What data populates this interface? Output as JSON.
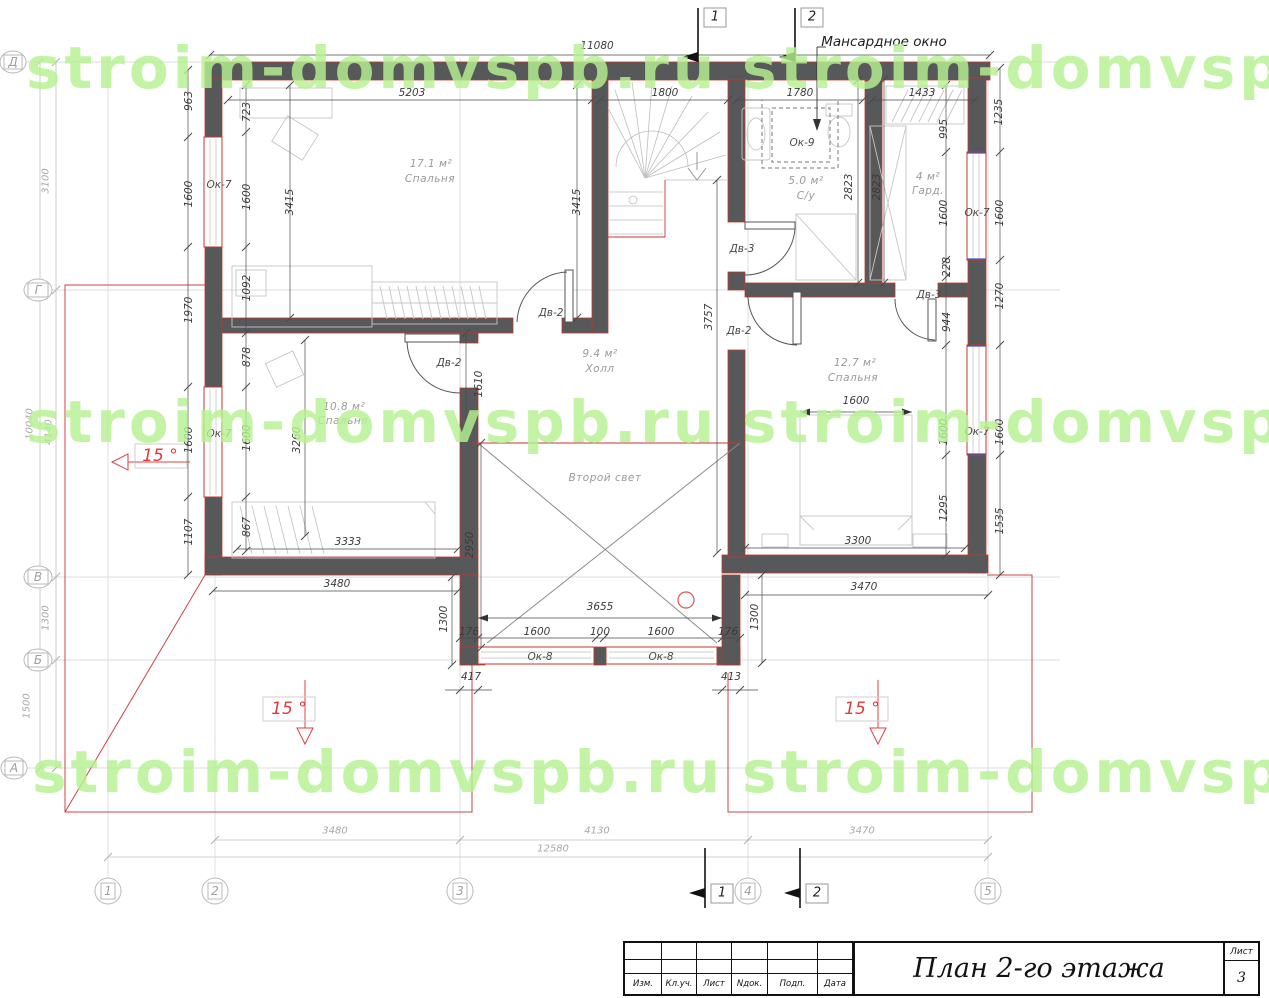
{
  "watermark": {
    "full": "stroim-domvspb.ru",
    "partial": "stroim-domvsp",
    "color": "#b7f292"
  },
  "colors": {
    "wall": "#57585a",
    "accent_red": "#c0392b",
    "roof_red": "#cc4444",
    "dim_text": "#3b3b3b",
    "faint_text": "#a8a8a8",
    "watermark": "#b7f292"
  },
  "grid": {
    "rows": [
      "Д",
      "Г",
      "В",
      "Б",
      "А"
    ],
    "cols": [
      "1",
      "2",
      "3",
      "4",
      "5"
    ]
  },
  "sections": {
    "top": [
      "1",
      "2"
    ],
    "bottom": [
      "1",
      "2"
    ]
  },
  "rooms": [
    {
      "area": "17.1 м²",
      "name": "Спальня"
    },
    {
      "area": "5.0 м²",
      "name": "С/у"
    },
    {
      "area": "4 м²",
      "name": "Гард."
    },
    {
      "area": "9.4 м²",
      "name": "Холл"
    },
    {
      "area": "10.8 м²",
      "name": "Спальня"
    },
    {
      "area": "12.7 м²",
      "name": "Спальня"
    },
    {
      "area": "",
      "name": "Второй свет"
    }
  ],
  "openings": {
    "windows": [
      "Ок-7",
      "Ок-8",
      "Ок-9"
    ],
    "doors": [
      "Дв-2",
      "Дв-3"
    ]
  },
  "slope_label": "15 °",
  "annotation_mansard": "Мансардное окно",
  "title_block": {
    "title": "План 2-го этажа",
    "sheet_label": "Лист",
    "sheet_number": "3",
    "columns": [
      "Изм.",
      "Кл.уч.",
      "Лист",
      "Nдок.",
      "Подп.",
      "Дата"
    ]
  },
  "labels": [
    {
      "t": "11080",
      "x": 597,
      "y": 46,
      "c": "d"
    },
    {
      "t": "5203",
      "x": 412,
      "y": 93,
      "c": "d"
    },
    {
      "t": "1800",
      "x": 665,
      "y": 93,
      "c": "d"
    },
    {
      "t": "1780",
      "x": 800,
      "y": 93,
      "c": "d"
    },
    {
      "t": "1433",
      "x": 922,
      "y": 93,
      "c": "d"
    },
    {
      "t": "995",
      "x": 944,
      "y": 129,
      "r": 1,
      "c": "d"
    },
    {
      "t": "1235",
      "x": 999,
      "y": 112,
      "r": 1,
      "c": "d"
    },
    {
      "t": "2823",
      "x": 849,
      "y": 187,
      "r": 1,
      "c": "d"
    },
    {
      "t": "2823",
      "x": 877,
      "y": 187,
      "r": 1,
      "c": "d"
    },
    {
      "t": "1600",
      "x": 944,
      "y": 213,
      "r": 1,
      "c": "d"
    },
    {
      "t": "1600",
      "x": 1000,
      "y": 213,
      "r": 1,
      "c": "d"
    },
    {
      "t": "Ок-7",
      "x": 977,
      "y": 213,
      "c": "o"
    },
    {
      "t": "228",
      "x": 947,
      "y": 267,
      "r": 1,
      "c": "d"
    },
    {
      "t": "1270",
      "x": 1000,
      "y": 296,
      "r": 1,
      "c": "d"
    },
    {
      "t": "Дв-3",
      "x": 929,
      "y": 295,
      "c": "o"
    },
    {
      "t": "944",
      "x": 947,
      "y": 322,
      "r": 1,
      "c": "d"
    },
    {
      "t": "1600",
      "x": 944,
      "y": 432,
      "r": 1,
      "c": "d"
    },
    {
      "t": "1600",
      "x": 1000,
      "y": 432,
      "r": 1,
      "c": "d"
    },
    {
      "t": "Ок-7",
      "x": 977,
      "y": 432,
      "c": "o"
    },
    {
      "t": "1295",
      "x": 944,
      "y": 508,
      "r": 1,
      "c": "d"
    },
    {
      "t": "1535",
      "x": 1000,
      "y": 521,
      "r": 1,
      "c": "d"
    },
    {
      "t": "963",
      "x": 189,
      "y": 101,
      "r": 1,
      "c": "d"
    },
    {
      "t": "723",
      "x": 247,
      "y": 112,
      "r": 1,
      "c": "d"
    },
    {
      "t": "1600",
      "x": 189,
      "y": 194,
      "r": 1,
      "c": "d"
    },
    {
      "t": "1600",
      "x": 247,
      "y": 197,
      "r": 1,
      "c": "d"
    },
    {
      "t": "Ок-7",
      "x": 219,
      "y": 185,
      "c": "o"
    },
    {
      "t": "3415",
      "x": 290,
      "y": 202,
      "r": 1,
      "c": "d"
    },
    {
      "t": "3415",
      "x": 577,
      "y": 202,
      "r": 1,
      "c": "d"
    },
    {
      "t": "1970",
      "x": 189,
      "y": 310,
      "r": 1,
      "c": "d"
    },
    {
      "t": "1092",
      "x": 247,
      "y": 288,
      "r": 1,
      "c": "d"
    },
    {
      "t": "878",
      "x": 247,
      "y": 357,
      "r": 1,
      "c": "d"
    },
    {
      "t": "1600",
      "x": 189,
      "y": 440,
      "r": 1,
      "c": "d"
    },
    {
      "t": "1600",
      "x": 247,
      "y": 438,
      "r": 1,
      "c": "d"
    },
    {
      "t": "Ок-7",
      "x": 219,
      "y": 434,
      "c": "o"
    },
    {
      "t": "3260",
      "x": 297,
      "y": 440,
      "r": 1,
      "c": "d"
    },
    {
      "t": "1107",
      "x": 189,
      "y": 532,
      "r": 1,
      "c": "d"
    },
    {
      "t": "867",
      "x": 247,
      "y": 527,
      "r": 1,
      "c": "d"
    },
    {
      "t": "3333",
      "x": 348,
      "y": 542,
      "c": "d"
    },
    {
      "t": "Дв-2",
      "x": 551,
      "y": 313,
      "c": "o"
    },
    {
      "t": "Дв-2",
      "x": 449,
      "y": 363,
      "c": "o"
    },
    {
      "t": "Дв-3",
      "x": 742,
      "y": 249,
      "c": "o"
    },
    {
      "t": "Дв-2",
      "x": 739,
      "y": 331,
      "c": "o"
    },
    {
      "t": "3757",
      "x": 709,
      "y": 317,
      "r": 1,
      "c": "d"
    },
    {
      "t": "1610",
      "x": 479,
      "y": 384,
      "r": 1,
      "c": "d"
    },
    {
      "t": "2950",
      "x": 470,
      "y": 545,
      "r": 1,
      "c": "d"
    },
    {
      "t": "1600",
      "x": 856,
      "y": 401,
      "c": "d"
    },
    {
      "t": "3300",
      "x": 858,
      "y": 541,
      "c": "d"
    },
    {
      "t": "3655",
      "x": 600,
      "y": 607,
      "c": "d"
    },
    {
      "t": "176",
      "x": 469,
      "y": 632,
      "c": "d"
    },
    {
      "t": "1600",
      "x": 537,
      "y": 632,
      "c": "d"
    },
    {
      "t": "100",
      "x": 600,
      "y": 632,
      "c": "d"
    },
    {
      "t": "1600",
      "x": 661,
      "y": 632,
      "c": "d"
    },
    {
      "t": "176",
      "x": 728,
      "y": 632,
      "c": "d"
    },
    {
      "t": "Ок-8",
      "x": 540,
      "y": 657,
      "c": "o"
    },
    {
      "t": "Ок-8",
      "x": 661,
      "y": 657,
      "c": "o"
    },
    {
      "t": "417",
      "x": 471,
      "y": 677,
      "c": "d"
    },
    {
      "t": "413",
      "x": 731,
      "y": 677,
      "c": "d"
    },
    {
      "t": "1300",
      "x": 444,
      "y": 619,
      "r": 1,
      "c": "d"
    },
    {
      "t": "1300",
      "x": 755,
      "y": 617,
      "r": 1,
      "c": "d"
    },
    {
      "t": "3480",
      "x": 337,
      "y": 584,
      "c": "d"
    },
    {
      "t": "3470",
      "x": 864,
      "y": 587,
      "c": "d"
    },
    {
      "t": "3100",
      "x": 46,
      "y": 181,
      "r": 1,
      "c": "f"
    },
    {
      "t": "10040",
      "x": 30,
      "y": 424,
      "r": 1,
      "c": "f"
    },
    {
      "t": "4140",
      "x": 49,
      "y": 432,
      "r": 1,
      "c": "f"
    },
    {
      "t": "1300",
      "x": 46,
      "y": 618,
      "r": 1,
      "c": "f"
    },
    {
      "t": "1500",
      "x": 27,
      "y": 706,
      "r": 1,
      "c": "f"
    },
    {
      "t": "3480",
      "x": 335,
      "y": 831,
      "c": "f"
    },
    {
      "t": "4130",
      "x": 597,
      "y": 831,
      "c": "f"
    },
    {
      "t": "3470",
      "x": 862,
      "y": 831,
      "c": "f"
    },
    {
      "t": "12580",
      "x": 553,
      "y": 849,
      "c": "f"
    },
    {
      "t": "17.1 м²",
      "x": 431,
      "y": 164,
      "c": "rm"
    },
    {
      "t": "Спальня",
      "x": 430,
      "y": 179,
      "c": "rm"
    },
    {
      "t": "5.0 м²",
      "x": 806,
      "y": 181,
      "c": "rm"
    },
    {
      "t": "С/у",
      "x": 806,
      "y": 196,
      "c": "rm"
    },
    {
      "t": "4 м²",
      "x": 928,
      "y": 177,
      "c": "rm"
    },
    {
      "t": "Гард.",
      "x": 928,
      "y": 191,
      "c": "rm"
    },
    {
      "t": "9.4 м²",
      "x": 600,
      "y": 354,
      "c": "rm"
    },
    {
      "t": "Холл",
      "x": 600,
      "y": 369,
      "c": "rm"
    },
    {
      "t": "10.8 м²",
      "x": 344,
      "y": 407,
      "c": "rm"
    },
    {
      "t": "Спальня",
      "x": 343,
      "y": 421,
      "c": "rm"
    },
    {
      "t": "12.7 м²",
      "x": 855,
      "y": 363,
      "c": "rm"
    },
    {
      "t": "Спальня",
      "x": 853,
      "y": 378,
      "c": "rm"
    },
    {
      "t": "Второй свет",
      "x": 605,
      "y": 478,
      "c": "rm"
    },
    {
      "t": "Ок-9",
      "x": 802,
      "y": 143,
      "c": "o"
    },
    {
      "t": "Мансардное окно",
      "x": 884,
      "y": 42,
      "c": "a"
    },
    {
      "t": "Д",
      "x": 13,
      "y": 62,
      "c": "g"
    },
    {
      "t": "Г",
      "x": 38,
      "y": 290,
      "c": "g"
    },
    {
      "t": "В",
      "x": 38,
      "y": 577,
      "c": "g"
    },
    {
      "t": "Б",
      "x": 38,
      "y": 660,
      "c": "g"
    },
    {
      "t": "А",
      "x": 14,
      "y": 768,
      "c": "g"
    },
    {
      "t": "1",
      "x": 108,
      "y": 891,
      "c": "g"
    },
    {
      "t": "2",
      "x": 215,
      "y": 891,
      "c": "g"
    },
    {
      "t": "3",
      "x": 460,
      "y": 891,
      "c": "g"
    },
    {
      "t": "4",
      "x": 748,
      "y": 891,
      "c": "g"
    },
    {
      "t": "5",
      "x": 988,
      "y": 891,
      "c": "g"
    },
    {
      "t": "1",
      "x": 715,
      "y": 17,
      "c": "s"
    },
    {
      "t": "2",
      "x": 812,
      "y": 17,
      "c": "s"
    },
    {
      "t": "1",
      "x": 722,
      "y": 893,
      "c": "s"
    },
    {
      "t": "2",
      "x": 817,
      "y": 893,
      "c": "s"
    },
    {
      "t": "15 °",
      "x": 160,
      "y": 456,
      "c": "red"
    },
    {
      "t": "15 °",
      "x": 289,
      "y": 709,
      "c": "red"
    },
    {
      "t": "15 °",
      "x": 862,
      "y": 709,
      "c": "red"
    }
  ]
}
